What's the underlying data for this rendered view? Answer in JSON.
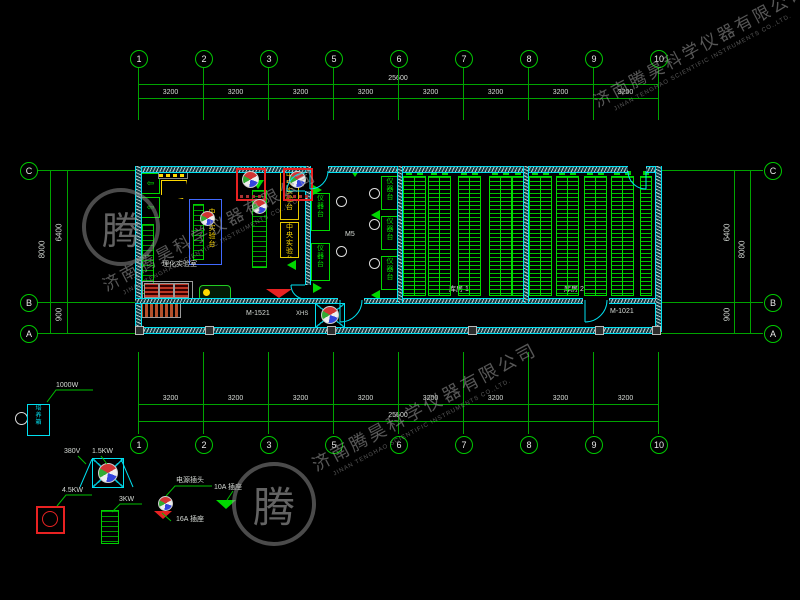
{
  "drawing": {
    "watermark": {
      "company_cn": "济南腾昊科学仪器有限公司",
      "company_en": "JINAN TENGHAO SCIENTIFIC INSTRUMENTS CO.,LTD.",
      "logo_char": "腾"
    },
    "grid": {
      "columns": [
        "1",
        "2",
        "3",
        "5",
        "6",
        "7",
        "8",
        "9",
        "10"
      ],
      "rows": [
        "C",
        "B",
        "A"
      ]
    },
    "dimensions": {
      "total_width": "25600",
      "bay_width": "3200",
      "overall_depth": "8000",
      "upper_depth": "6400",
      "lower_depth": "900"
    },
    "doors": {
      "door_left": "M-1521",
      "door_right": "M-1021"
    },
    "rooms": {
      "lab": "理化实验室",
      "mid_room": "M5",
      "storage_1": "库房 1",
      "storage_2": "库房 2",
      "central_bench": "中央实验台",
      "side_bench": "仪器台",
      "exhaust_fan": "XHS",
      "incubator": "培养箱"
    },
    "legend": {
      "heater_power": "1000W",
      "fan_voltage": "380V",
      "fan_power": "1.5KW",
      "oven_power": "4.5KW",
      "cabinet_power": "3KW",
      "plug": "电源插头",
      "socket_16a": "16A 插座",
      "socket_10a": "10A 插座"
    }
  }
}
